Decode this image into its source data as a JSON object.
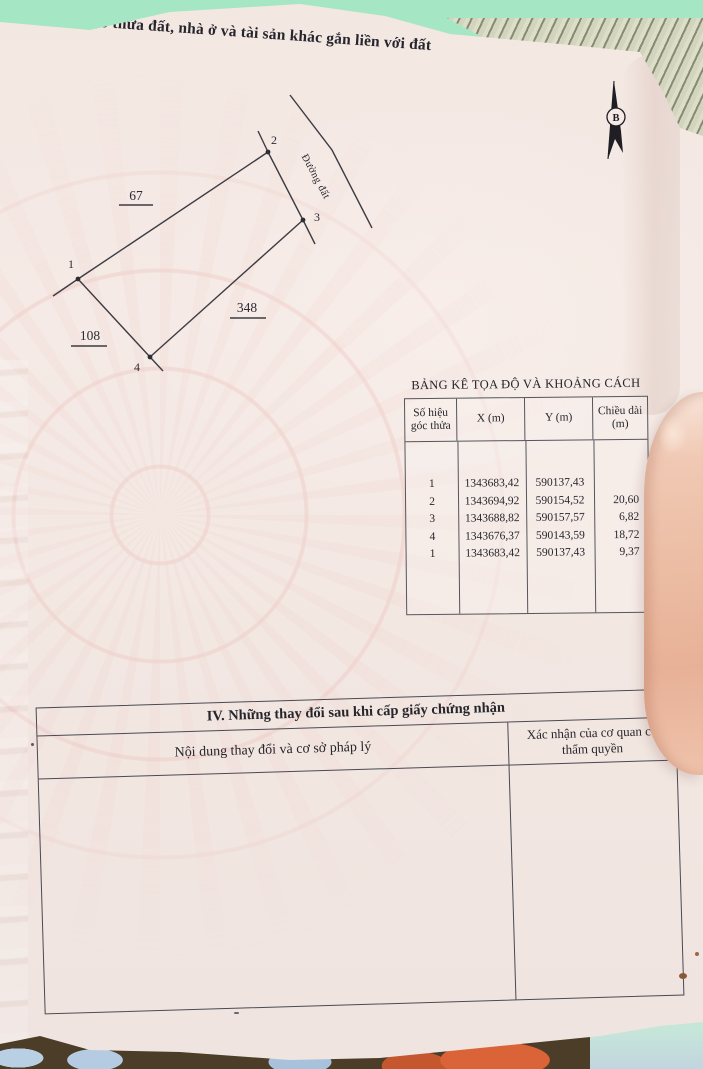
{
  "document": {
    "section3_title": "III. Sơ đồ thửa đất, nhà ở và tài sản khác gắn liền với đất",
    "section4": {
      "title": "IV. Những thay đổi sau khi cấp giấy chứng nhận",
      "columns": [
        "Nội dung thay đổi và cơ sở pháp lý",
        "Xác nhận của cơ quan có thẩm quyền"
      ]
    }
  },
  "diagram": {
    "north_label": "B",
    "road_label": "Đường đất",
    "vertex_labels": [
      "1",
      "2",
      "3",
      "4"
    ],
    "measure_labels": [
      "67",
      "348",
      "108"
    ]
  },
  "coord_table": {
    "title": "BẢNG KÊ TỌA ĐỘ VÀ KHOẢNG CÁCH",
    "columns": [
      "Số hiệu góc thửa",
      "X (m)",
      "Y (m)",
      "Chiều dài (m)"
    ],
    "rows": [
      [
        "1",
        "1343683,42",
        "590137,43",
        ""
      ],
      [
        "2",
        "1343694,92",
        "590154,52",
        "20,60"
      ],
      [
        "3",
        "1343688,82",
        "590157,57",
        "6,82"
      ],
      [
        "4",
        "1343676,37",
        "590143,59",
        "18,72"
      ],
      [
        "1",
        "1343683,42",
        "590137,43",
        "9,37"
      ]
    ]
  },
  "colors": {
    "page": "#f4e9e4",
    "cloth_green": "#a5e7c4",
    "fabric_dark": "#4b3d28",
    "fabric_orange": "#da6338",
    "fabric_blue": "#b4cbe2",
    "teal_corner": "#c6e6da",
    "finger_skin": "#eec0a8",
    "ink": "#3c3c42"
  }
}
